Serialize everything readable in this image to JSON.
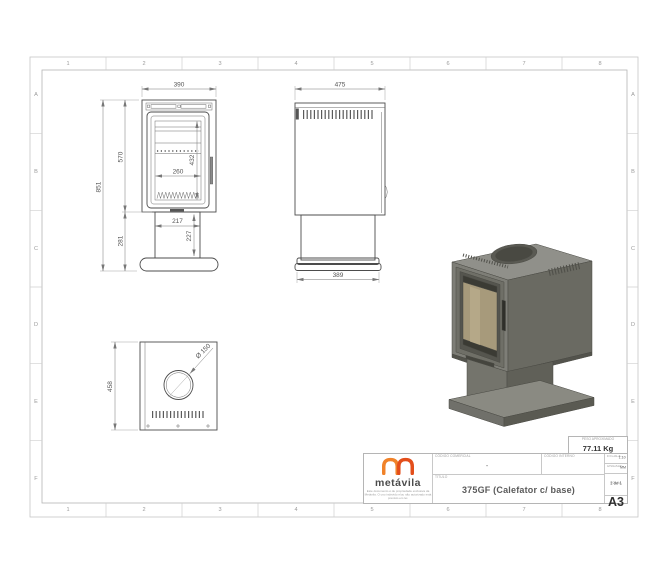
{
  "grid": {
    "columns": [
      "1",
      "2",
      "3",
      "4",
      "5",
      "6",
      "7",
      "8"
    ],
    "rows": [
      "A",
      "B",
      "C",
      "D",
      "E",
      "F"
    ]
  },
  "front_view": {
    "dims": {
      "width": "390",
      "overall_height": "851",
      "body_height": "570",
      "door_glass_height": "432",
      "door_glass_width": "260",
      "pedestal_width": "217",
      "pedestal_height": "227",
      "lower_height": "281"
    }
  },
  "side_view": {
    "dims": {
      "depth": "475",
      "base_depth": "389"
    }
  },
  "top_view": {
    "dims": {
      "depth": "458",
      "flue_diameter": "Ø 150"
    }
  },
  "title_block": {
    "logo_text": "metávila",
    "legal_text": "Este documento é de propriedade exclusiva da Metávila. O uso indevido e/ou não autorizado está previsto em lei.",
    "weight_label": "PESO APROXIMADO",
    "weight_value": "77.11 Kg",
    "commercial_code_label": "CÓDIGO COMERCIAL",
    "commercial_code_value": "-",
    "internal_code_label": "CÓDIGO INTERNO",
    "title_label": "TÍTULO",
    "title_value": "375GF (Calefator c/ base)",
    "scale_label": "ESCALA",
    "scale_value": "1:10",
    "unit_label": "UNIDADE",
    "unit_value": "MM",
    "sheet_label": "FOLHA",
    "sheet_value": "1 de 1",
    "paper_size": "A3"
  },
  "colors": {
    "logo_orange": "#F08229",
    "logo_red": "#E34E1B",
    "stove_gray": "#6a6a62",
    "drawing_line": "#4c4c4c",
    "border_gray": "#b5b5b5"
  }
}
